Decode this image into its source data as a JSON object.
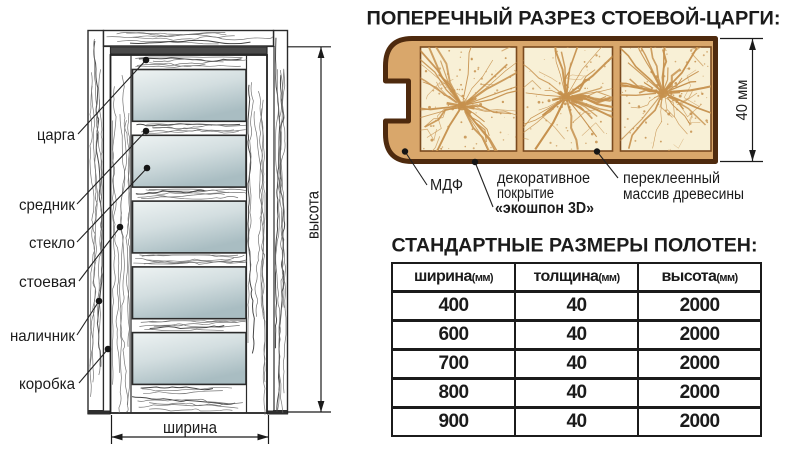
{
  "door_diagram": {
    "part_labels": {
      "tsarga": "царга",
      "srednik": "средник",
      "steklo": "стекло",
      "stoevaya": "стоевая",
      "nalichnik": "наличник",
      "korobka": "коробка"
    },
    "dimension_labels": {
      "height": "высота",
      "width": "ширина"
    },
    "colors": {
      "glass_top": "#eef3f3",
      "glass_mid": "#d3dee0",
      "glass_bottom": "#a9bdc2",
      "outline": "#2b2b2b",
      "grain": "#6e6e6e"
    }
  },
  "cross_section": {
    "title": "ПОПЕРЕЧНЫЙ РАЗРЕЗ СТОЕВОЙ-ЦАРГИ:",
    "dimension_label": "40 мм",
    "labels": {
      "mdf": "МДФ",
      "coating_line1": "декоративное",
      "coating_line2": "покрытие",
      "coating_line3": "«экошпон 3D»",
      "core_line1": "переклеенный",
      "core_line2": "массив древесины"
    },
    "colors": {
      "outline": "#4e2a0e",
      "body_fill": "#d9a76b",
      "panel_fill": "#f8f0d6",
      "panel_border": "#7a4a1e",
      "crack": "#c6914e"
    }
  },
  "size_table": {
    "title": "СТАНДАРТНЫЕ РАЗМЕРЫ ПОЛОТЕН:",
    "columns": [
      {
        "label": "ширина",
        "unit": "(мм)"
      },
      {
        "label": "толщина",
        "unit": "(мм)"
      },
      {
        "label": "высота",
        "unit": "(мм)"
      }
    ],
    "rows": [
      [
        "400",
        "40",
        "2000"
      ],
      [
        "600",
        "40",
        "2000"
      ],
      [
        "700",
        "40",
        "2000"
      ],
      [
        "800",
        "40",
        "2000"
      ],
      [
        "900",
        "40",
        "2000"
      ]
    ]
  }
}
